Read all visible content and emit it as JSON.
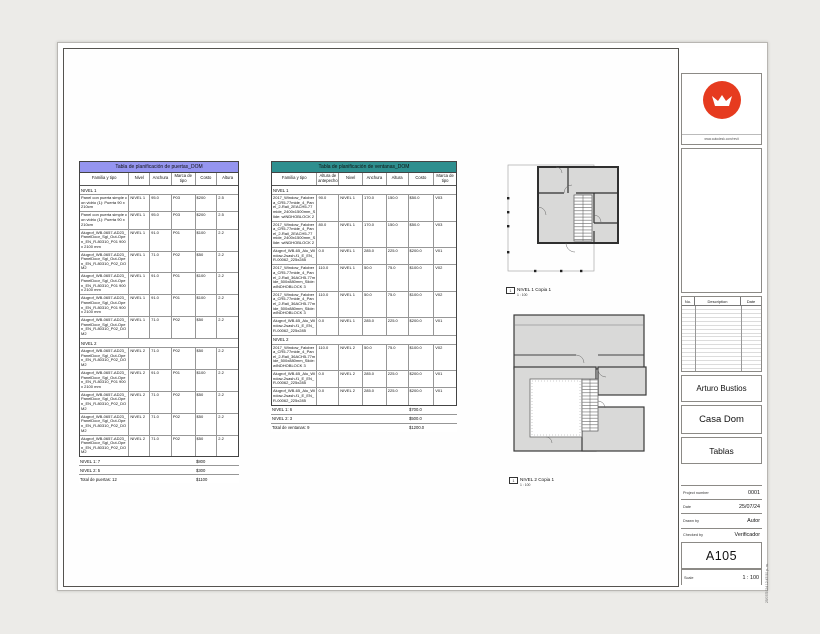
{
  "titleblock": {
    "logo_caption": "www.autodesk.com/revit",
    "revisions": {
      "no_label": "No.",
      "description_label": "Description",
      "date_label": "Date"
    },
    "owner": "Arturo Bustios",
    "project": "Casa Dom",
    "sheet_name": "Tablas",
    "project_number_label": "Project number",
    "project_number": "0001",
    "date_label": "Date",
    "date": "25/07/24",
    "drawn_by_label": "Drawn by",
    "drawn_by": "Autor",
    "checked_by_label": "Checked by",
    "checked_by": "Verificador",
    "sheet_number": "A105",
    "scale_label": "Scale",
    "scale": "1 : 100",
    "print_stamp": "25/07/2024 12:47:50 p. m.",
    "logo_color": "#e63b1f"
  },
  "door_schedule": {
    "title": "Tabla de planificación de puertas_DOM",
    "title_bg": "#9595f0",
    "value_col": 4,
    "columns": [
      {
        "label": "Familia y tipo",
        "width": 50
      },
      {
        "label": "Nivel",
        "width": 21
      },
      {
        "label": "Anchura",
        "width": 22
      },
      {
        "label": "Marca de tipo",
        "width": 24
      },
      {
        "label": "Costo",
        "width": 22
      },
      {
        "label": "Altura",
        "width": 21
      }
    ],
    "rows": [
      {
        "type": "group",
        "label": "NIVEL 1"
      },
      {
        "type": "data",
        "cells": [
          "Panel con puerta simple con vidrio (1): Puerta 90 x 210cm",
          "NIVEL 1",
          "95.0",
          "P03",
          "$200",
          "2.5"
        ]
      },
      {
        "type": "data",
        "cells": [
          "Panel con puerta simple con vidrio (1): Puerta 90 x 210cm",
          "NIVEL 1",
          "95.0",
          "P03",
          "$200",
          "2.5"
        ]
      },
      {
        "type": "data",
        "cells": [
          "Alugrof_WB-0657-AD23_PanelDoor_Sgl_Out-Open_EN_R-80310_P01 900 x 2100 mm",
          "NIVEL 1",
          "91.0",
          "P01",
          "$100",
          "2.2"
        ]
      },
      {
        "type": "data",
        "cells": [
          "Alugrof_WB-0657-AD23_PanelDoor_Sgl_Out-Open_EN_R-80310_P02_DOM2",
          "NIVEL 1",
          "71.0",
          "P02",
          "$50",
          "2.2"
        ]
      },
      {
        "type": "data",
        "cells": [
          "Alugrof_WB-0657-AD23_PanelDoor_Sgl_Out-Open_EN_R-80310_P01 900 x 2100 mm",
          "NIVEL 1",
          "91.0",
          "P01",
          "$100",
          "2.2"
        ]
      },
      {
        "type": "data",
        "cells": [
          "Alugrof_WB-0657-AD23_PanelDoor_Sgl_Out-Open_EN_R-80310_P01 900 x 2100 mm",
          "NIVEL 1",
          "91.0",
          "P01",
          "$100",
          "2.2"
        ]
      },
      {
        "type": "data",
        "cells": [
          "Alugrof_WB-0657-AD23_PanelDoor_Sgl_Out-Open_EN_R-80310_P02_DOM2",
          "NIVEL 1",
          "71.0",
          "P02",
          "$50",
          "2.2"
        ]
      },
      {
        "type": "subtotal",
        "label": "NIVEL 1: 7",
        "value": "$800"
      },
      {
        "type": "group",
        "label": "NIVEL 2"
      },
      {
        "type": "data",
        "cells": [
          "Alugrof_WB-0657-AD23_PanelDoor_Sgl_Out-Open_EN_R-80310_P02_DOM2",
          "NIVEL 2",
          "71.0",
          "P02",
          "$50",
          "2.2"
        ]
      },
      {
        "type": "data",
        "cells": [
          "Alugrof_WB-0657-AD23_PanelDoor_Sgl_Out-Open_EN_R-80310_P01 900 x 2100 mm",
          "NIVEL 2",
          "91.0",
          "P01",
          "$100",
          "2.2"
        ]
      },
      {
        "type": "data",
        "cells": [
          "Alugrof_WB-0657-AD23_PanelDoor_Sgl_Out-Open_EN_R-80310_P02_DOM2",
          "NIVEL 2",
          "71.0",
          "P02",
          "$50",
          "2.2"
        ]
      },
      {
        "type": "data",
        "cells": [
          "Alugrof_WB-0657-AD23_PanelDoor_Sgl_Out-Open_EN_R-80310_P02_DOM2",
          "NIVEL 2",
          "71.0",
          "P02",
          "$50",
          "2.2"
        ]
      },
      {
        "type": "data",
        "cells": [
          "Alugrof_WB-0657-AD23_PanelDoor_Sgl_Out-Open_EN_R-80310_P02_DOM2",
          "NIVEL 2",
          "71.0",
          "P02",
          "$50",
          "2.2"
        ]
      },
      {
        "type": "subtotal",
        "label": "NIVEL 2: 5",
        "value": "$300"
      },
      {
        "type": "total",
        "label": "Total de puertas: 12",
        "value": "$1100"
      }
    ]
  },
  "window_schedule": {
    "title": "Tabla de planificación de ventanas_DOM",
    "title_bg": "#2e8f8f",
    "value_col": 5,
    "columns": [
      {
        "label": "Familia y tipo",
        "width": 46
      },
      {
        "label": "Altura de antepecho",
        "width": 22
      },
      {
        "label": "Nivel",
        "width": 24
      },
      {
        "label": "Anchura",
        "width": 24
      },
      {
        "label": "Altura",
        "width": 22
      },
      {
        "label": "Costo",
        "width": 26
      },
      {
        "label": "Marca de tipo",
        "width": 22
      }
    ],
    "rows": [
      {
        "type": "group",
        "label": "NIVEL 1"
      },
      {
        "type": "data",
        "cells": [
          "2017_Window_Falobera_CR5-77mide_4_Panel_2-Rail_2EACH5-77mide_2400x1500mm_Slide: wINDHOBLOCK 2",
          "90.0",
          "NIVEL 1",
          "170.0",
          "150.0",
          "$50.0",
          "V03"
        ]
      },
      {
        "type": "data",
        "cells": [
          "2017_Window_Falobera_CR5-77mide_4_Panel_2-Rail_2EACH5-77mide_2400x1500mm_Slide: wINDHOBLOCK 2",
          "80.0",
          "NIVEL 1",
          "170.0",
          "150.0",
          "$50.0",
          "V03"
        ]
      },
      {
        "type": "data",
        "cells": [
          "Alugrof_WB-65_Alu_Window-2sash-f1_E_EN_R-00062_225x285",
          "0.0",
          "NIVEL 1",
          "285.0",
          "225.0",
          "$200.0",
          "V01"
        ]
      },
      {
        "type": "data",
        "cells": [
          "2017_Window_Falobera_CR5-77mide_4_Panel_2-Rail_36ACH5-77mide_500x880mm_Slide: wINDHOBLOCK 3",
          "110.0",
          "NIVEL 1",
          "50.0",
          "75.0",
          "$100.0",
          "V02"
        ]
      },
      {
        "type": "data",
        "cells": [
          "2017_Window_Falobera_CR5-77mide_4_Panel_2-Rail_36ACH5-77mide_500x880mm_Slide: wINDHOBLOCK 3",
          "110.0",
          "NIVEL 1",
          "50.0",
          "75.0",
          "$100.0",
          "V02"
        ]
      },
      {
        "type": "data",
        "cells": [
          "Alugrof_WB-65_Alu_Window-2sash-f1_E_EN_R-00062_225x285",
          "0.0",
          "NIVEL 1",
          "285.0",
          "225.0",
          "$200.0",
          "V01"
        ]
      },
      {
        "type": "subtotal",
        "label": "NIVEL 1: 6",
        "value": "$700.0"
      },
      {
        "type": "group",
        "label": "NIVEL 2"
      },
      {
        "type": "data",
        "cells": [
          "2017_Window_Falobera_CR5-77mide_4_Panel_2-Rail_36ACH5-77mide_500x880mm_Slide: wINDHOBLOCK 3",
          "110.0",
          "NIVEL 2",
          "50.0",
          "75.0",
          "$100.0",
          "V02"
        ]
      },
      {
        "type": "data",
        "cells": [
          "Alugrof_WB-65_Alu_Window-2sash-f1_E_EN_R-00062_225x285",
          "0.0",
          "NIVEL 2",
          "285.0",
          "225.0",
          "$200.0",
          "V01"
        ]
      },
      {
        "type": "data",
        "cells": [
          "Alugrof_WB-65_Alu_Window-2sash-f1_E_EN_R-00062_225x285",
          "0.0",
          "NIVEL 2",
          "285.0",
          "225.0",
          "$200.0",
          "V01"
        ]
      },
      {
        "type": "subtotal",
        "label": "NIVEL 2: 3",
        "value": "$500.0"
      },
      {
        "type": "total",
        "label": "Total de ventanas: 9",
        "value": "$1200.0"
      }
    ]
  },
  "plans": [
    {
      "marker": "1",
      "name": "NIVEL 1 Copia 1",
      "scale": "1 : 100"
    },
    {
      "marker": "1",
      "name": "NIVEL 2 Copia 1",
      "scale": "1 : 100"
    }
  ]
}
